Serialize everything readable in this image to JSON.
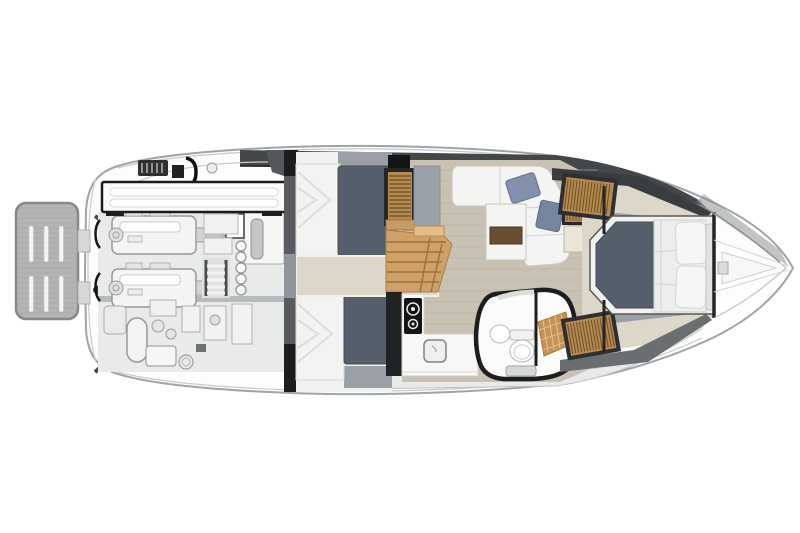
{
  "title": "Motor yacht lower-deck floor plan, top view, bow pointing right",
  "palette": {
    "hull_fill": "#fdfdfd",
    "hull_line": "#9fa4a6",
    "sheer_line": "#c6c9ca",
    "side_deck_dark": "#43474a",
    "side_deck_light": "#e8eaea",
    "teak_gray": "#b4b4b2",
    "slot_white": "#f4f4f2",
    "bench_white": "#fafaf9",
    "bench_border": "#1a1c1d",
    "engine_white": "#f4f4f3",
    "machinery_line": "#96989a",
    "bulkhead_black": "#1b1d1f",
    "mattress_slate": "#555e6b",
    "quilt_white": "#f3f3f1",
    "carpet_cream": "#dcd7c8",
    "stair_oak": "#cfa167",
    "louver_wood": "#b5894f",
    "louver_slat": "#6b5026",
    "floor_wood": "#c9c1b2",
    "plank_line": "#b8afa0",
    "sofa_white": "#f4f4f2",
    "pillow_blue_a": "#8190ac",
    "pillow_blue_b": "#75849f",
    "walnut": "#6b4e31",
    "counter_white": "#f7f7f6",
    "cooktop_black": "#131416",
    "shower_teak": "#c59355",
    "duvet_white": "#eceded",
    "gray_panel": "#9aa0a6"
  },
  "vessel": {
    "orientation": "bow-right",
    "areas": [
      {
        "id": "swim-platform",
        "label": "Teak swim platform with six deck slots"
      },
      {
        "id": "engine-room",
        "label": "Engine room: twin engines, generator, water heater, systems"
      },
      {
        "id": "cockpit-bench",
        "label": "Aft cockpit bench seat with two cushions"
      },
      {
        "id": "guest-cabin",
        "label": "Aft guest cabin with two slate single berths"
      },
      {
        "id": "staircase",
        "label": "Companionway stairs with louvered locker"
      },
      {
        "id": "salon",
        "label": "Salon: L-shaped sofa, two blue pillows, walnut table"
      },
      {
        "id": "galley",
        "label": "Galley: two-burner cooktop and sink"
      },
      {
        "id": "head",
        "label": "Head: basin, toilet, teak shower floor"
      },
      {
        "id": "master-cabin",
        "label": "Forward master cabin with island berth and louvered wardrobes"
      },
      {
        "id": "bow-deck",
        "label": "Foredeck with anchor locker"
      }
    ],
    "counts": {
      "engines": 2,
      "guest_berths": 2,
      "island_beds": 1,
      "throw_pillows": 2,
      "burners": 2,
      "platform_slots": 6
    }
  }
}
